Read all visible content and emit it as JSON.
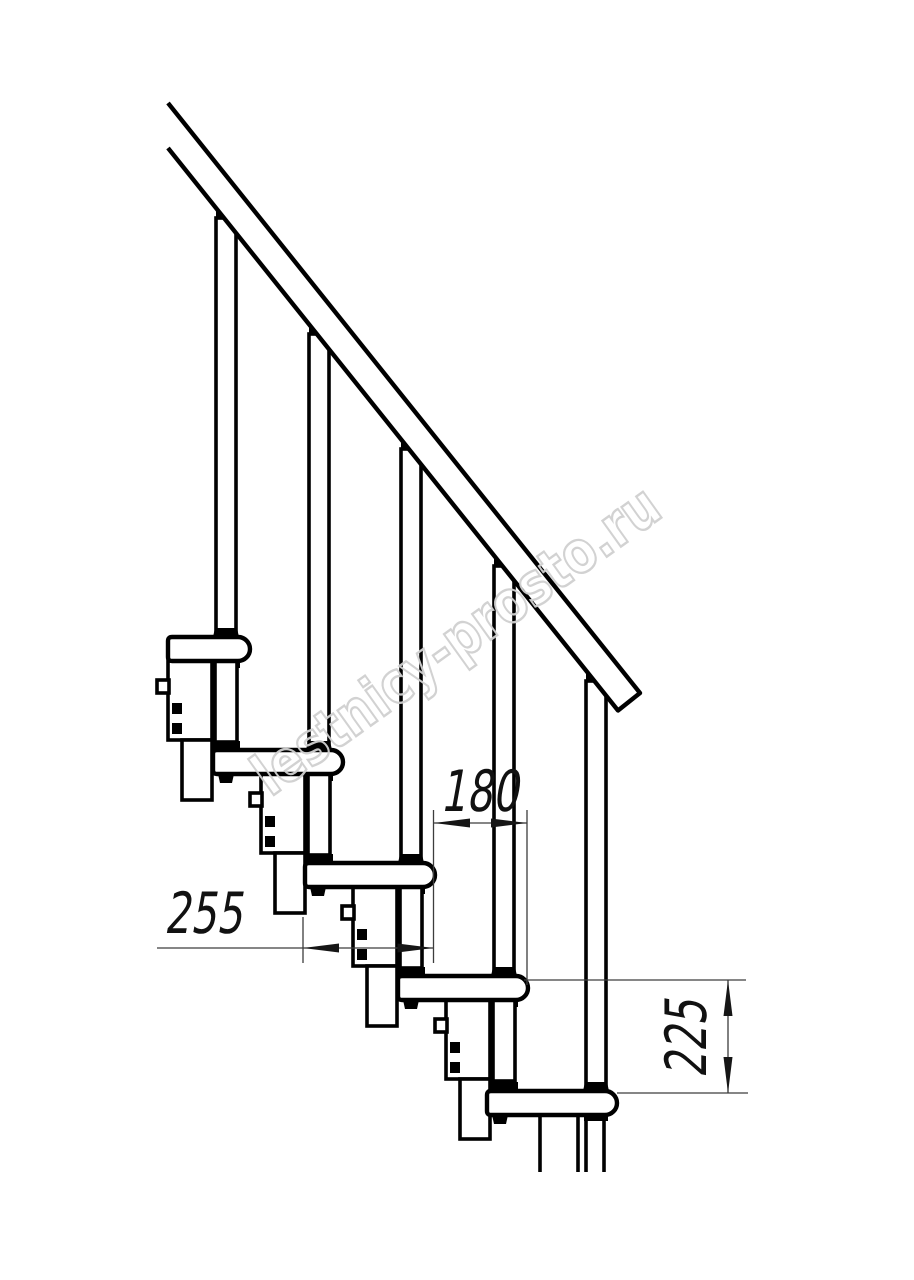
{
  "watermark": {
    "text": "lestnicy-prosto.ru"
  },
  "dimensions": {
    "step_run": "180",
    "tread_depth": "255",
    "step_rise": "225"
  }
}
